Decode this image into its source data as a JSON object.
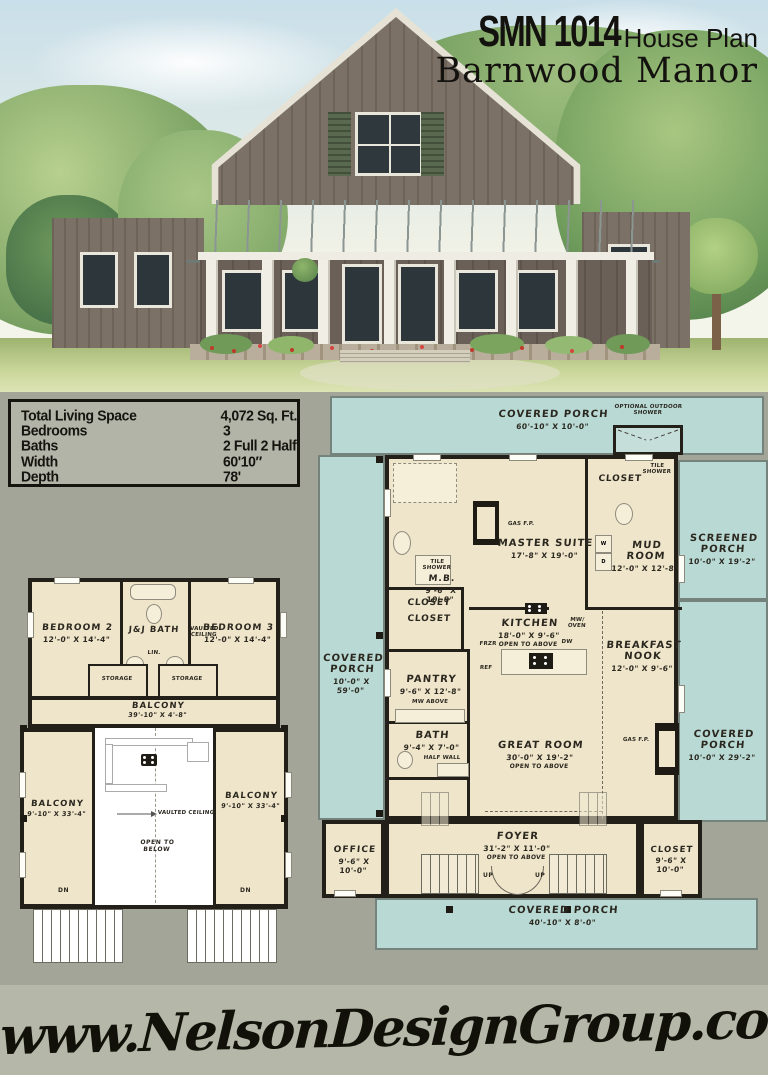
{
  "header": {
    "plan_number": "SMN 1014",
    "plan_type": "House Plan",
    "plan_name": "Barnwood Manor"
  },
  "stats": {
    "rows": [
      {
        "label": "Total Living Space",
        "value": "4,072 Sq. Ft."
      },
      {
        "label": "Bedrooms",
        "value": "3"
      },
      {
        "label": "Baths",
        "value": "2 Full 2 Half"
      },
      {
        "label": "Width",
        "value": "60'10″"
      },
      {
        "label": "Depth",
        "value": "78'"
      }
    ]
  },
  "main_floor": {
    "covered_porch_top": {
      "name": "COVERED PORCH",
      "dims": "60'-10\" X 10'-0\""
    },
    "optional_outdoor_shower": {
      "name": "OPTIONAL OUTDOOR SHOWER"
    },
    "closet_master": {
      "name": "CLOSET"
    },
    "tile_shower_master": {
      "name": "TILE SHOWER"
    },
    "gas_fp_master": {
      "name": "GAS F.P."
    },
    "master_suite": {
      "name": "MASTER SUITE",
      "dims": "17'-8\" X 19'-0\""
    },
    "master_bath": {
      "name": "M.B.",
      "dims": "9'-6\" X 10'-8\""
    },
    "closet_mud": {
      "name": "CLOSET"
    },
    "tile_shower_mud": {
      "name": "TILE SHOWER"
    },
    "mud_room": {
      "name": "MUD ROOM",
      "dims": "12'-0\" X 12'-8\""
    },
    "washer": "W",
    "dryer": "D",
    "screened_porch": {
      "name": "SCREENED PORCH",
      "dims": "10'-0\" X 19'-2\""
    },
    "closet_kitchen": {
      "name": "CLOSET"
    },
    "kitchen": {
      "name": "KITCHEN",
      "dims": "18'-0\" X 9'-6\"",
      "note": "OPEN TO ABOVE"
    },
    "mw_oven": "MW/ OVEN",
    "frzr": "FRZR",
    "ref": "REF",
    "dw": "DW",
    "breakfast_nook": {
      "name": "BREAKFAST NOOK",
      "dims": "12'-0\" X 9'-6\""
    },
    "covered_porch_left": {
      "name": "COVERED PORCH",
      "dims": "10'-0\" X 59'-0\""
    },
    "pantry": {
      "name": "PANTRY",
      "dims": "9'-6\" X 12'-8\"",
      "note": "MW ABOVE"
    },
    "bath": {
      "name": "BATH",
      "dims": "9'-4\" X 7'-0\"",
      "note": "HALF WALL"
    },
    "great_room": {
      "name": "GREAT ROOM",
      "dims": "30'-0\" X 19'-2\"",
      "note": "OPEN TO ABOVE"
    },
    "gas_fp_great": {
      "name": "GAS F.P."
    },
    "covered_porch_right": {
      "name": "COVERED PORCH",
      "dims": "10'-0\" X 29'-2\""
    },
    "office": {
      "name": "OFFICE",
      "dims": "9'-6\" X 10'-0\""
    },
    "foyer": {
      "name": "FOYER",
      "dims": "31'-2\" X 11'-0\"",
      "note": "OPEN TO ABOVE"
    },
    "closet_foyer": {
      "name": "CLOSET",
      "dims": "9'-6\" X 10'-0\""
    },
    "covered_porch_bottom": {
      "name": "COVERED PORCH",
      "dims": "40'-10\" X 8'-0\""
    },
    "up_label": "UP"
  },
  "second_floor": {
    "bedroom_2": {
      "name": "BEDROOM 2",
      "dims": "12'-0\" X 14'-4\""
    },
    "jj_bath": {
      "name": "J&J BATH"
    },
    "vaulted_ceiling": "VAULTED CEILING",
    "bedroom_3": {
      "name": "BEDROOM 3",
      "dims": "12'-0\" X 14'-4\""
    },
    "storage": "STORAGE",
    "linen": "LIN.",
    "balcony_top": {
      "name": "BALCONY",
      "dims": "39'-10\" X 4'-8\""
    },
    "balcony_left": {
      "name": "BALCONY",
      "dims": "9'-10\" X 33'-4\""
    },
    "balcony_right": {
      "name": "BALCONY",
      "dims": "9'-10\" X 33'-4\""
    },
    "open_to_below": "OPEN TO BELOW",
    "dn_label": "DN"
  },
  "footer": {
    "website": "www.NelsonDesignGroup.com"
  },
  "colors": {
    "porch_teal": "#b9d9d4",
    "interior_cream": "#efe5ca",
    "wall_black": "#23201a",
    "page_gray": "#a3a599",
    "footer_gray": "#b5b8a8"
  }
}
